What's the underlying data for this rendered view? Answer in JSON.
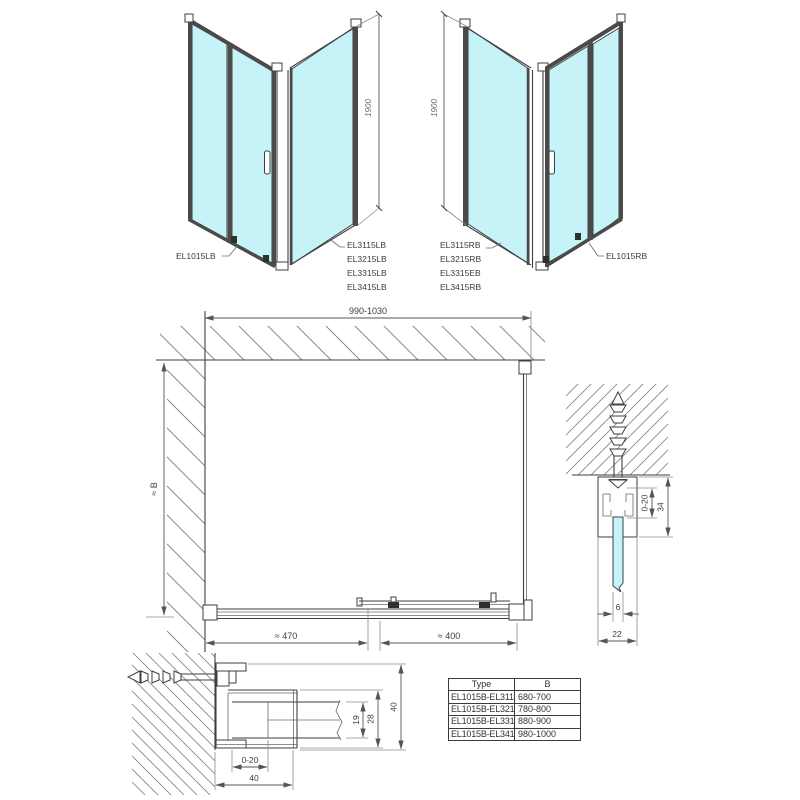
{
  "figures": {
    "top_left": {
      "dimension_height": "1900",
      "door_label": "EL1015LB",
      "panel_labels": [
        "EL3115LB",
        "EL3215LB",
        "EL3315LB",
        "EL3415LB"
      ]
    },
    "top_right": {
      "dimension_height": "1900",
      "panel_labels": [
        "EL3115RB",
        "EL3215RB",
        "EL3315EB",
        "EL3415RB"
      ],
      "door_label": "EL1015RB"
    },
    "plan_view": {
      "width_dim": "990-1030",
      "depth_dim": "≈ B",
      "left_segment_dim": "≈ 470",
      "right_segment_dim": "≈ 400"
    },
    "wall_profile_detail": {
      "adjust_dim": "0-20",
      "profile_height_dim": "34",
      "glass_thickness_dim": "6",
      "profile_width_dim": "22"
    },
    "floor_profile_detail": {
      "adjust_dim": "0-20",
      "adjust_total_dim": "40",
      "pocket_dim": "19",
      "body_dim": "28",
      "total_dim": "40"
    }
  },
  "table": {
    "headers": [
      "Type",
      "B"
    ],
    "rows": [
      {
        "type": "EL1015B-EL3115B",
        "b": "680-700"
      },
      {
        "type": "EL1015B-EL3215B",
        "b": "780-800"
      },
      {
        "type": "EL1015B-EL3315B",
        "b": "880-900"
      },
      {
        "type": "EL1015B-EL3415B",
        "b": "980-1000"
      }
    ]
  },
  "colors": {
    "background": "#ffffff",
    "glass": "#c6f3f7",
    "line": "#3f3f3f",
    "dimension": "#555555",
    "hatch": "#8a8a8a"
  }
}
